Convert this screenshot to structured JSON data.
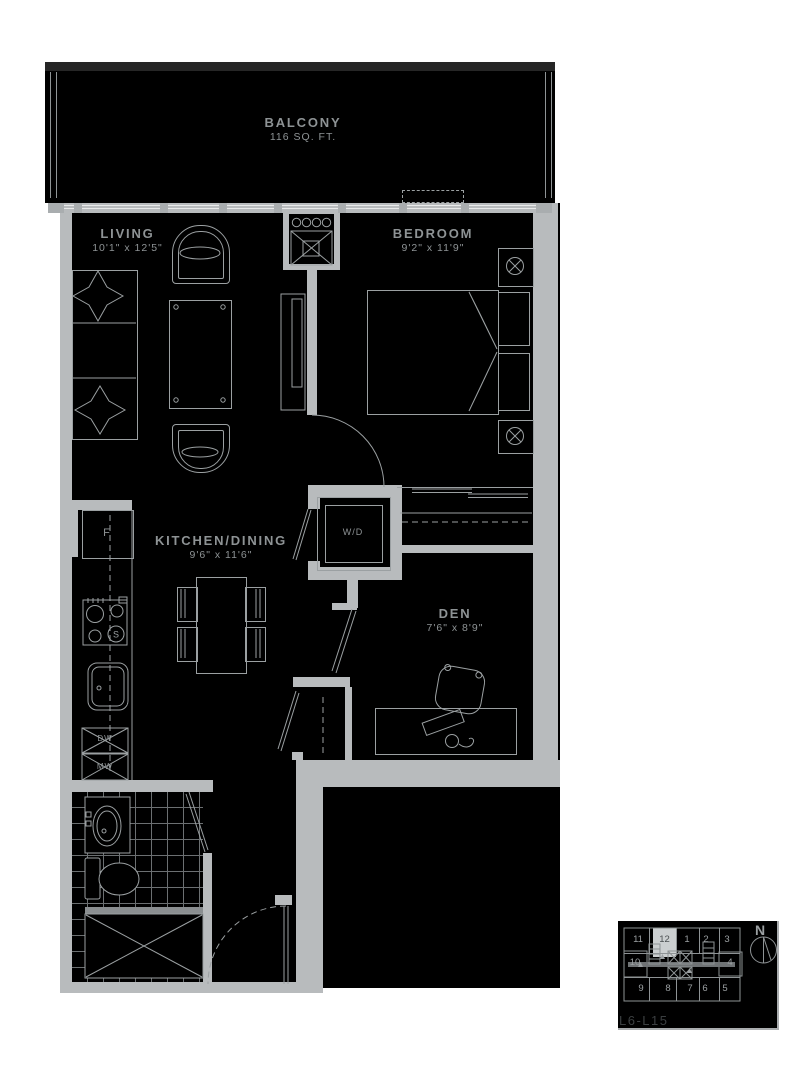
{
  "colors": {
    "wall_gray": "#b8bbbd",
    "furniture_line": "#9ba0a2",
    "label_gray": "#8e9395",
    "interior_fill": "#000000",
    "balcony_top_band": "#262626",
    "keyplan_highlight": "#cbcfd0",
    "keyplan_floor_text": "#3b3f41",
    "background": "#ffffff"
  },
  "balcony": {
    "label": "BALCONY",
    "area": "116 SQ. FT."
  },
  "rooms": {
    "living": {
      "label": "LIVING",
      "dims": "10'1\" x 12'5\""
    },
    "bedroom": {
      "label": "BEDROOM",
      "dims": "9'2\" x 11'9\""
    },
    "kitchen": {
      "label": "KITCHEN/DINING",
      "dims": "9'6\" x 11'6\""
    },
    "den": {
      "label": "DEN",
      "dims": "7'6\" x 8'9\""
    }
  },
  "fixtures": {
    "washer_dryer": "W/D",
    "fridge": "F",
    "dishwasher": "DW",
    "microwave": "MW",
    "stove_burner": "S"
  },
  "keyplan": {
    "north": "N",
    "floors": "L6-L15",
    "highlighted_unit": "12",
    "top_row": [
      "11",
      "12",
      "1",
      "2",
      "3"
    ],
    "middle_left": "10",
    "middle_right": "4",
    "bottom_row": [
      "9",
      "8",
      "7",
      "6",
      "5"
    ]
  }
}
